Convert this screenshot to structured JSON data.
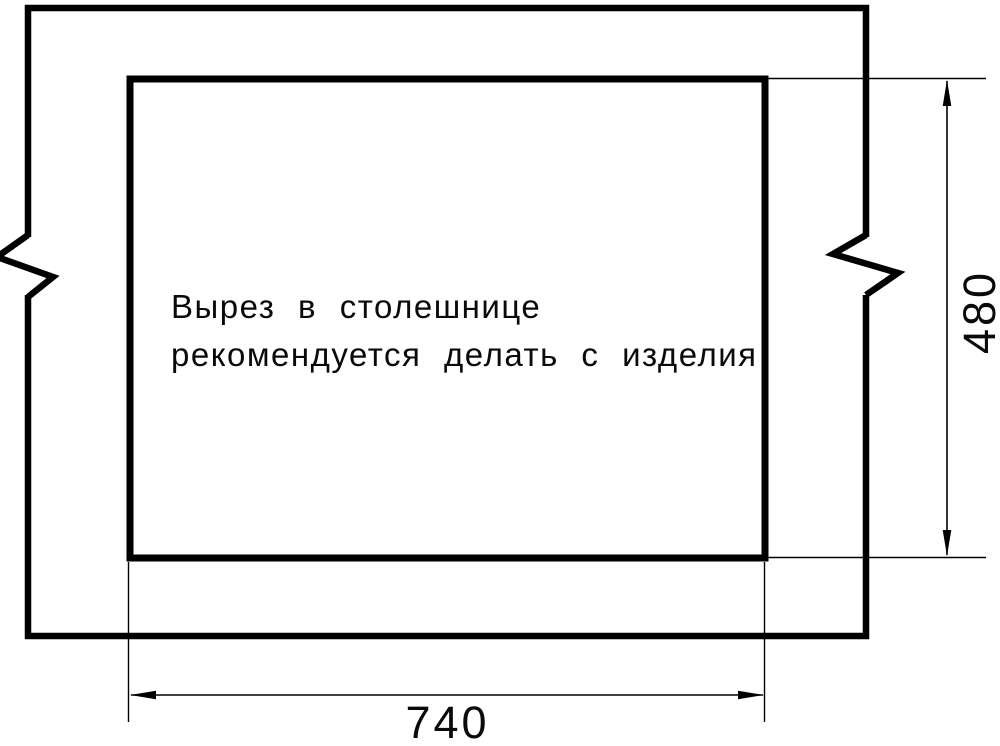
{
  "colors": {
    "line": "#000000",
    "background": "#ffffff"
  },
  "note": {
    "line1": "Вырез в столешнице",
    "line2": "рекомендуется делать с изделия"
  },
  "dimensions": {
    "width_label": "740",
    "height_label": "480"
  }
}
